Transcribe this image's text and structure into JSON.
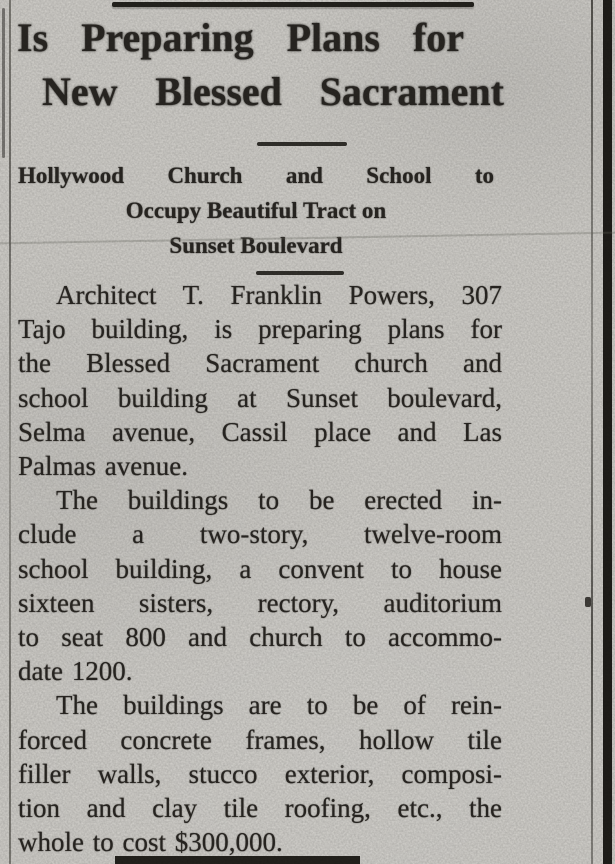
{
  "article": {
    "headline_lines": [
      "Is Preparing Plans for",
      "New Blessed Sacrament"
    ],
    "subhead_lines": [
      "Hollywood Church and School to",
      "Occupy Beautiful Tract on",
      "Sunset Boulevard"
    ],
    "paragraphs": [
      {
        "lines": [
          "Architect T. Franklin Powers, 307",
          "Tajo building, is preparing plans for",
          "the Blessed Sacrament church and",
          "school building at Sunset boulevard,",
          "Selma avenue, Cassil place and Las",
          "Palmas avenue."
        ]
      },
      {
        "lines": [
          "The buildings to be erected in-",
          "clude a two-story, twelve-room",
          "school building, a convent to house",
          "sixteen sisters, rectory, auditorium",
          "to seat 800 and church to accommo-",
          "date 1200."
        ]
      },
      {
        "lines": [
          "The buildings are to be of rein-",
          "forced concrete frames, hollow tile",
          "filler walls, stucco exterior, composi-",
          "tion and clay tile roofing, etc., the",
          "whole to cost $300,000."
        ]
      }
    ]
  },
  "colors": {
    "paper": "#d5d3ce",
    "ink": "#2b2824",
    "rule": "#26241f"
  }
}
